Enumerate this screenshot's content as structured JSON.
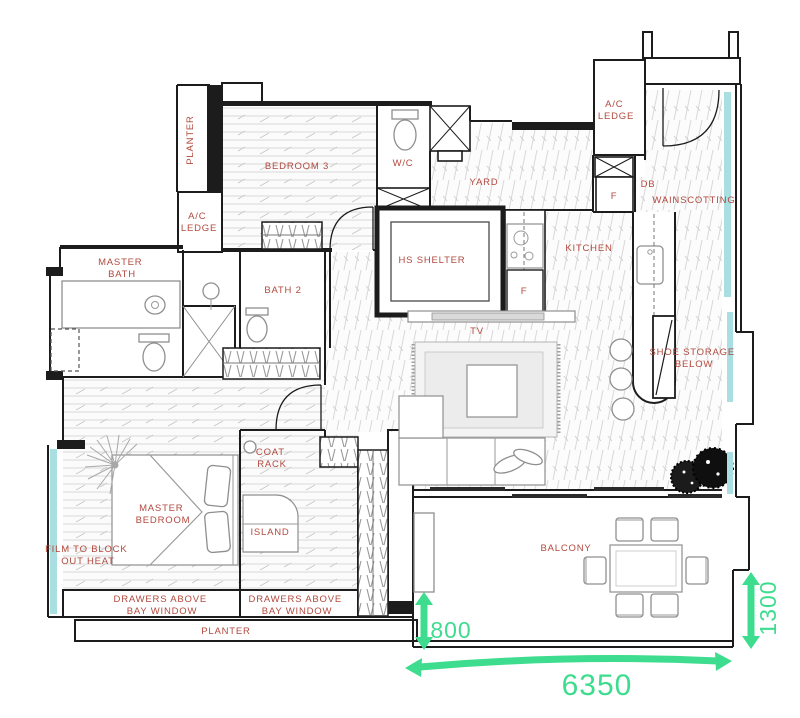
{
  "title": "Apartment floor plan with balcony dimensions",
  "colors": {
    "label_red": "#b2493e",
    "dimension_green": "#3edc8e",
    "window_teal": "#a9dfe0",
    "wall_black": "#1c1c1c"
  },
  "labels": {
    "planter_top": "PLANTER",
    "ac_ledge_left": {
      "l1": "A/C",
      "l2": "LEDGE"
    },
    "bedroom3": "BEDROOM 3",
    "wc": "W/C",
    "yard": "YARD",
    "ac_ledge_right": {
      "l1": "A/C",
      "l2": "LEDGE"
    },
    "db": "DB",
    "fuse_top": "F",
    "wainscotting": "WAINSCOTTING",
    "master_bath": {
      "l1": "MASTER",
      "l2": "BATH"
    },
    "bath2": "BATH 2",
    "hs_shelter": "HS SHELTER",
    "kitchen": "KITCHEN",
    "fridge": "F",
    "tv": "TV",
    "shoe_storage": {
      "l1": "SHOE STORAGE",
      "l2": "BELOW"
    },
    "coat_rack": {
      "l1": "COAT",
      "l2": "RACK"
    },
    "master_bedroom": {
      "l1": "MASTER",
      "l2": "BEDROOM"
    },
    "island": "ISLAND",
    "film": {
      "l1": "FILM TO BLOCK",
      "l2": "OUT HEAT"
    },
    "drawers_left": {
      "l1": "DRAWERS ABOVE",
      "l2": "BAY WINDOW"
    },
    "drawers_right": {
      "l1": "DRAWERS ABOVE",
      "l2": "BAY WINDOW"
    },
    "planter_bottom": "PLANTER",
    "balcony": "BALCONY"
  },
  "dimensions_mm": {
    "balcony_offset": "800",
    "balcony_width": "6350",
    "balcony_depth": "1300"
  }
}
